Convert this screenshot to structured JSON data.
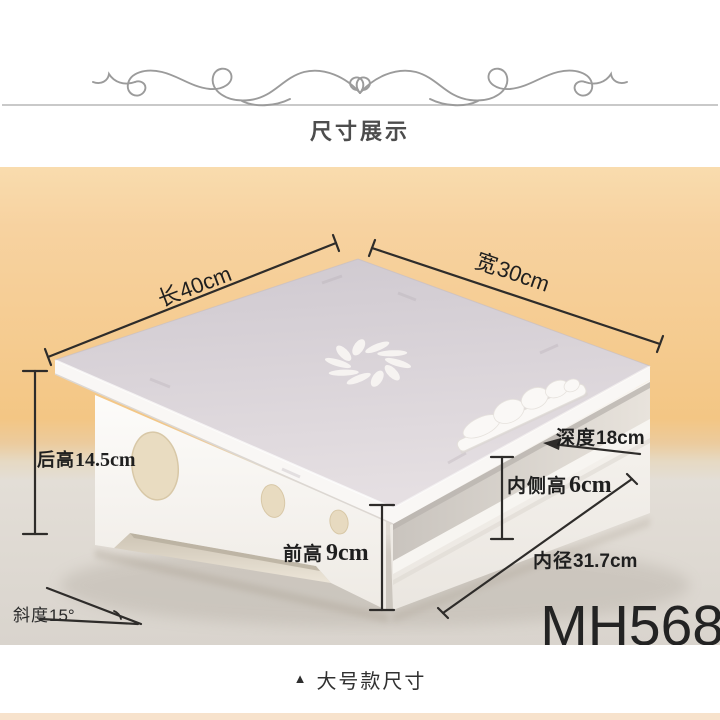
{
  "header": {
    "title": "尺寸展示"
  },
  "photo": {
    "model": "MH568",
    "dimensions": {
      "length": {
        "label": "长",
        "value": "40cm"
      },
      "width": {
        "label": "宽",
        "value": "30cm"
      },
      "back_height": {
        "label": "后高",
        "value": "14.5cm"
      },
      "depth": {
        "label": "深度",
        "value": "18cm"
      },
      "inner_side_height": {
        "label": "内侧高",
        "value": "6cm"
      },
      "front_height": {
        "label": "前高",
        "value": "9cm"
      },
      "inner_diameter": {
        "label": "内径",
        "value": "31.7cm"
      },
      "slope": {
        "label": "斜度",
        "value": "15°"
      }
    }
  },
  "footer": {
    "marker": "▲",
    "caption": "大号款尺寸"
  },
  "colors": {
    "backdrop_peach": "#f5cb8f",
    "surface_gray": "#ddd8d1",
    "product_top": "#d6d0d6",
    "annotation_line": "#2e2c2a",
    "bottom_strip": "#f7e2cc"
  }
}
